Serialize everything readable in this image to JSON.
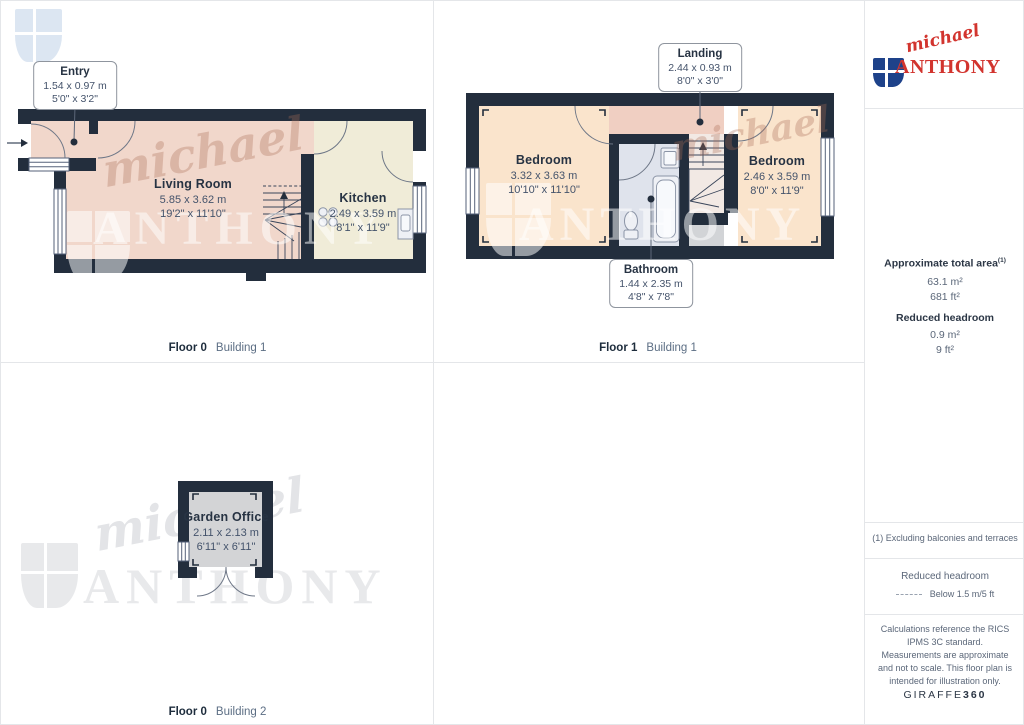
{
  "plans": [
    {
      "floor_label": "Floor 0",
      "building_label": "Building 1",
      "rooms": [
        {
          "name": "Living Room",
          "dim_m": "5.85 x 3.62 m",
          "dim_ft": "19'2\" x 11'10\""
        },
        {
          "name": "Kitchen",
          "dim_m": "2.49 x 3.59 m",
          "dim_ft": "8'1\" x 11'9\""
        }
      ],
      "callouts": [
        {
          "name": "Entry",
          "dim_m": "1.54 x 0.97 m",
          "dim_ft": "5'0\" x 3'2\""
        }
      ]
    },
    {
      "floor_label": "Floor 1",
      "building_label": "Building 1",
      "rooms": [
        {
          "name": "Bedroom",
          "dim_m": "3.32 x 3.63 m",
          "dim_ft": "10'10\" x 11'10\""
        },
        {
          "name": "Bedroom",
          "dim_m": "2.46 x 3.59 m",
          "dim_ft": "8'0\" x 11'9\""
        }
      ],
      "callouts": [
        {
          "name": "Landing",
          "dim_m": "2.44 x 0.93 m",
          "dim_ft": "8'0\" x 3'0\""
        },
        {
          "name": "Bathroom",
          "dim_m": "1.44 x 2.35 m",
          "dim_ft": "4'8\" x 7'8\""
        }
      ]
    },
    {
      "floor_label": "Floor 0",
      "building_label": "Building 2",
      "rooms": [
        {
          "name": "Garden Office",
          "dim_m": "2.11 x 2.13 m",
          "dim_ft": "6'11\" x 6'11\""
        }
      ]
    }
  ],
  "sidebar": {
    "logo": {
      "script": "michael",
      "caps": "ANTHONY"
    },
    "area": {
      "title": "Approximate total area",
      "title_sup": "(1)",
      "m2": "63.1 m²",
      "ft2": "681 ft²",
      "reduced_title": "Reduced headroom",
      "reduced_m2": "0.9 m²",
      "reduced_ft2": "9 ft²"
    },
    "footnote": "(1) Excluding balconies and terraces",
    "legend": {
      "title": "Reduced headroom",
      "item": "Below 1.5 m/5 ft"
    },
    "disclaimer": "Calculations reference the RICS IPMS 3C standard. Measurements are approximate and not to scale. This floor plan is intended for illustration only.",
    "brand": {
      "name": "GIRAFFE",
      "suffix": "360"
    }
  },
  "watermark": {
    "script": "michael",
    "caps": "ANTHONY"
  },
  "colors": {
    "wall": "#232e3d",
    "living": "#f1d7cb",
    "landing": "#f0cfc2",
    "bedroom": "#fae4cc",
    "kitchen": "#f0ecd8",
    "bath": "#dfe3ec",
    "office": "#d3d4d6",
    "grayzone": "#d2d4d7",
    "stairbg": "#f2e9e4",
    "line": "#6e7787",
    "winline": "#56627a",
    "fixture": "#eef0f5",
    "fixline": "#8b94a6",
    "stair": "#39455a",
    "leader": "#5c6779",
    "ink": "#273343",
    "dim": "#44536b",
    "muted": "#5c6e84",
    "sideink": "#2b3645",
    "sidemuted": "#5b6779",
    "red": "#d2342e",
    "blue": "#1e428a",
    "grid": "#e4e6e9",
    "wmgray": "#e8e9eb",
    "wmblue": "#dce6f2",
    "wmscript": "rgba(172,108,88,0.32)",
    "wmwhite": "rgba(255,255,255,0.52)"
  }
}
